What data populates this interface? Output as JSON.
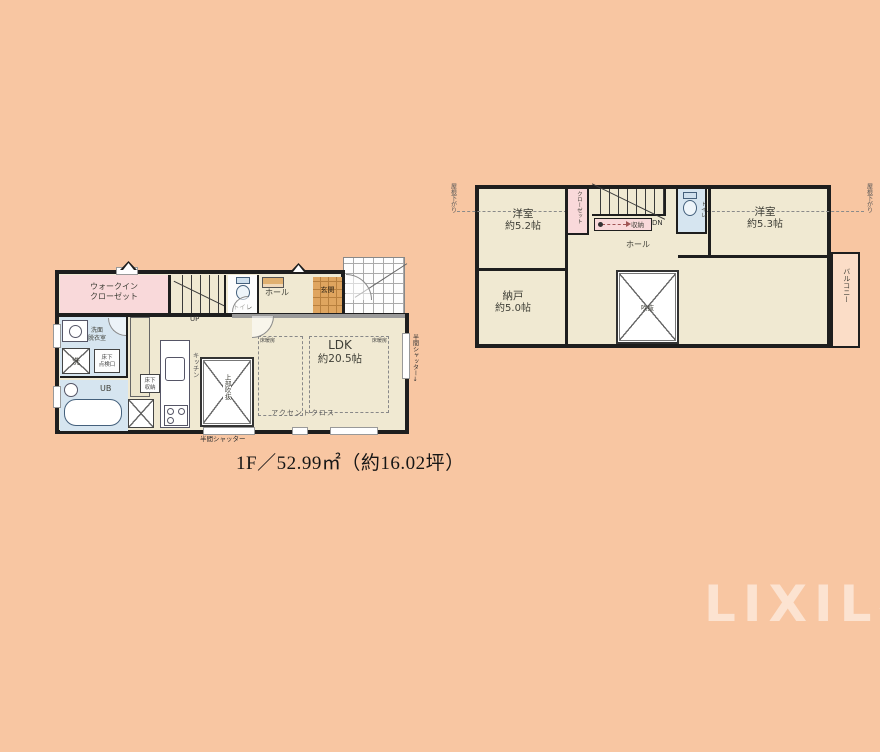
{
  "colors": {
    "background": "#f8c6a2",
    "room_cream": "#f0e9d2",
    "closet_pink": "#f9d9da",
    "bath_blue": "#d6e5f0",
    "entrance_tan": "#dfa55f",
    "wall": "#1e1e1e",
    "callout_border": "#ec8e8e"
  },
  "watermark": "LIXIL不動産ショップ",
  "f1": {
    "area": "1F／52.99㎡（約16.02坪）",
    "wic1": "ウォークイン",
    "wic2": "クローゼット",
    "up": "UP",
    "toilet": "トイレ",
    "hall": "ホール",
    "genkan": "玄関",
    "wash1": "洗面",
    "wash2": "脱衣室",
    "laundry": "洗",
    "insp1": "床下",
    "insp2": "点検口",
    "ub": "UB",
    "kitchen": "キッチン",
    "fs1": "床下",
    "fs2": "収納",
    "voidlbl": "上部吹抜",
    "ldk1": "LDK",
    "ldk2": "約20.5帖",
    "fh": "床暖房",
    "accent": "アクセントクロス",
    "shutter": "半間シャッター",
    "shutter_r": "半間シャッター↓"
  },
  "f2": {
    "area": "2F／51.82㎡（約15.67坪）",
    "r52a": "洋室",
    "r52b": "約5.2帖",
    "r53a": "洋室",
    "r53b": "約5.3帖",
    "r78a": "洋室",
    "r78b": "約7.8帖",
    "nandoa": "納戸",
    "nandob": "約5.0帖",
    "closet_top": "クローゼット",
    "storage": "収納",
    "dn": "DN",
    "toilet": "トイレ",
    "hall": "ホール",
    "voidlbl": "吹抜",
    "closet_small": "クローゼット",
    "wic1": "ウォークイン",
    "wic2": "クローゼット",
    "balcony": "バルコニー",
    "roof": "屋根下がり",
    "accent": "アクセントクロス"
  },
  "callout": {
    "line1": "ワンフロアに4つも収納があるので",
    "line2": "ばっちり整理整頓できちゃいます",
    "sparkle": "✧"
  }
}
